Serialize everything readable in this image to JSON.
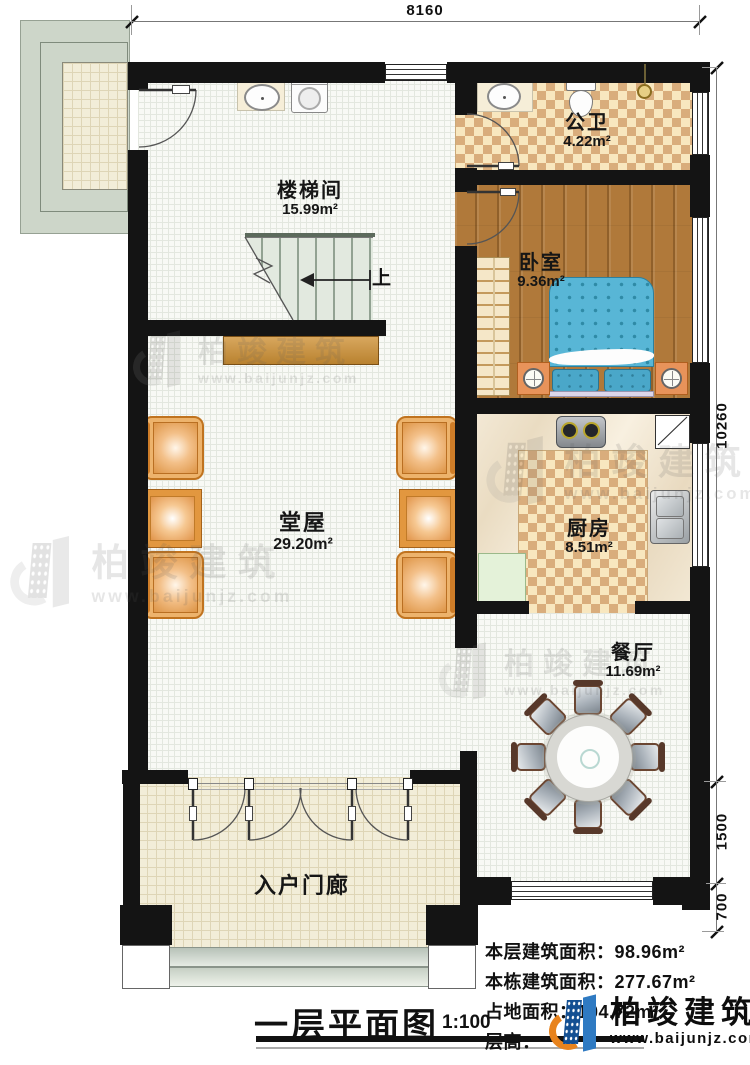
{
  "title": {
    "text": "一层平面图",
    "scale": "1:100"
  },
  "dimensions": {
    "top_width": "8160",
    "right_total": "10260",
    "right_mid": "1500",
    "right_bottom": "700"
  },
  "rooms": {
    "stairwell": {
      "name": "楼梯间",
      "area": "15.99m²"
    },
    "bathroom": {
      "name": "公卫",
      "area": "4.22m²"
    },
    "bedroom": {
      "name": "卧室",
      "area": "9.36m²"
    },
    "hall": {
      "name": "堂屋",
      "area": "29.20m²"
    },
    "kitchen": {
      "name": "厨房",
      "area": "8.51m²"
    },
    "dining": {
      "name": "餐厅",
      "area": "11.69m²"
    },
    "porch": {
      "name": "入户门廊"
    }
  },
  "stairs": {
    "direction_label": "上"
  },
  "info_lines": [
    "本层建筑面积：98.96m²",
    "本栋建筑面积：277.67m²",
    "占地面积：104.72m²",
    "层高："
  ],
  "logo": {
    "name": "柏竣建筑",
    "website": "www.baijunjz.com"
  },
  "watermark": {
    "name": "柏竣建筑",
    "website": "www.baijunjz.com"
  },
  "colors": {
    "wall": "#141414",
    "checker_tan": "#d9ad7c",
    "wood_floor": "#b0793a",
    "bed_blue": "#58b6d6",
    "chair_orange": "#e5a057",
    "logo_blue": "#134f92",
    "logo_orange": "#e8831d"
  }
}
